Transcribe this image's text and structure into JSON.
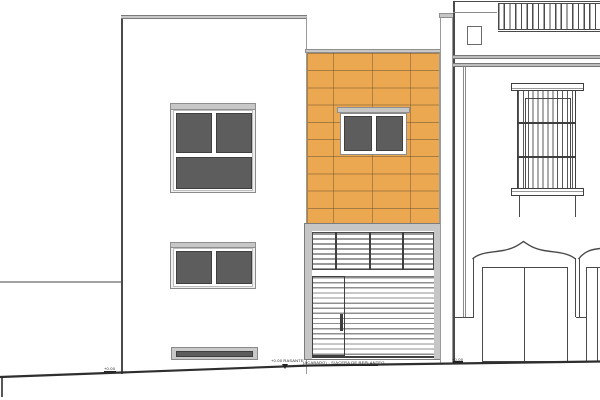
{
  "drawing": {
    "type": "architectural-street-elevation",
    "annotations": {
      "ground_marker_left": "+0.00",
      "ground_marker_center_level": "+0.00 RASANTE",
      "ground_marker_center_note": "(ACABADO) - S/ACERA DE REPLANTEO",
      "ground_marker_right": "+0.00"
    },
    "colors": {
      "paper": "#ffffff",
      "tile_accent": "#eba850",
      "glass_dark": "#5d5d5d",
      "frame_light_gray": "#c7c7c7",
      "cornice_gray": "#bdbdbd",
      "line_dark": "#3f3f3f",
      "line_medium": "#8a8a8a",
      "ground_line": "#2e2e2e"
    },
    "counts": {
      "tile_rows": 10,
      "tile_columns": 4,
      "roller_door_slats": 16,
      "transom_columns": 4,
      "roof_railing_bars": 18
    }
  }
}
